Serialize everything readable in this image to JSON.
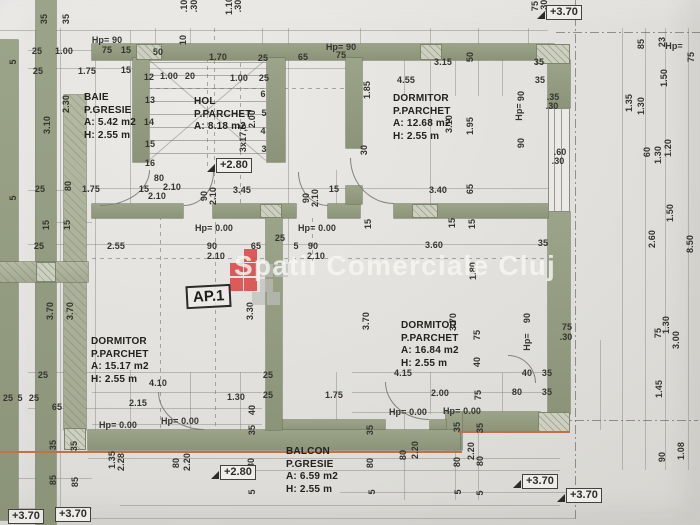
{
  "watermark": {
    "text": "Spatii Comerciale Cluj"
  },
  "ap_label": "AP.1",
  "colors": {
    "wall_green": "#8f987e",
    "paper": "#e0dfdb",
    "accent_orange": "#c0714a",
    "logo_red": "#d84343",
    "logo_gray": "#bdbdba",
    "text": "#35352f"
  },
  "rooms": {
    "baie": {
      "line1": "BAIE",
      "line2": "P.GRESIE",
      "area": "A: 5.42 m2",
      "height": "H: 2.55 m"
    },
    "hol": {
      "line1": "HOL",
      "line2": "P.PARCHET",
      "area": "A: 8.18 m2",
      "height": ""
    },
    "dormitor1": {
      "line1": "DORMITOR",
      "line2": "P.PARCHET",
      "area": "A: 12.68 m2",
      "height": "H: 2.55 m"
    },
    "dormitor2": {
      "line1": "DORMITOR",
      "line2": "P.PARCHET",
      "area": "A: 15.17 m2",
      "height": "H: 2.55 m"
    },
    "dormitor3": {
      "line1": "DORMITOR",
      "line2": "P.PARCHET",
      "area": "A: 16.84 m2",
      "height": "H: 2.55 m"
    },
    "balcon": {
      "line1": "BALCON",
      "line2": "P.GRESIE",
      "area": "A: 6.59 m2",
      "height": "H: 2.55 m"
    }
  },
  "level_markers": [
    {
      "text": "+3.70",
      "x": 546,
      "y": 2,
      "tri": 1
    },
    {
      "text": "+2.80",
      "x": 216,
      "y": 155,
      "tri": 1
    },
    {
      "text": "+2.80",
      "x": 220,
      "y": 462,
      "tri": 1
    },
    {
      "text": "+3.70",
      "x": 8,
      "y": 506
    },
    {
      "text": "+3.70",
      "x": 55,
      "y": 504
    },
    {
      "text": "+3.70",
      "x": 522,
      "y": 471,
      "tri": 1
    },
    {
      "text": "+3.70",
      "x": 566,
      "y": 485,
      "tri": 1
    }
  ],
  "dimensions": [
    {
      "t": "25",
      "x": 37,
      "y": 51
    },
    {
      "t": "1.00",
      "x": 64,
      "y": 51
    },
    {
      "t": "75",
      "x": 107,
      "y": 50
    },
    {
      "t": "15",
      "x": 126,
      "y": 50
    },
    {
      "t": "25",
      "x": 38,
      "y": 71
    },
    {
      "t": "1.75",
      "x": 87,
      "y": 71
    },
    {
      "t": "15",
      "x": 126,
      "y": 70
    },
    {
      "t": "50",
      "x": 158,
      "y": 52
    },
    {
      "t": "1.00",
      "x": 169,
      "y": 76
    },
    {
      "t": "20",
      "x": 190,
      "y": 76
    },
    {
      "t": "1.70",
      "x": 218,
      "y": 57
    },
    {
      "t": "25",
      "x": 263,
      "y": 58
    },
    {
      "t": "1.00",
      "x": 239,
      "y": 78
    },
    {
      "t": "25",
      "x": 264,
      "y": 78
    },
    {
      "t": "65",
      "x": 303,
      "y": 57
    },
    {
      "t": "75",
      "x": 341,
      "y": 55
    },
    {
      "t": "3.15",
      "x": 443,
      "y": 62
    },
    {
      "t": "50",
      "x": 470,
      "y": 57,
      "r": 1
    },
    {
      "t": "4.55",
      "x": 406,
      "y": 80
    },
    {
      "t": "35",
      "x": 539,
      "y": 62
    },
    {
      "t": "35",
      "x": 540,
      "y": 80
    },
    {
      "t": "Hp= 90",
      "x": 107,
      "y": 40
    },
    {
      "t": "Hp= 90",
      "x": 341,
      "y": 47
    },
    {
      "t": "Hp=",
      "x": 674,
      "y": 46
    },
    {
      "t": "75",
      "x": 691,
      "y": 57,
      "r": 1
    },
    {
      "t": ".10",
      "x": 184,
      "y": 6,
      "r": 1
    },
    {
      "t": ".30",
      "x": 194,
      "y": 6,
      "r": 1
    },
    {
      "t": "1.10",
      "x": 229,
      "y": 6,
      "r": 1
    },
    {
      "t": ".30",
      "x": 238,
      "y": 6,
      "r": 1
    },
    {
      "t": "75",
      "x": 535,
      "y": 6,
      "r": 1
    },
    {
      "t": ".30",
      "x": 544,
      "y": 6,
      "r": 1
    },
    {
      "t": "85",
      "x": 641,
      "y": 44,
      "r": 1
    },
    {
      "t": "23",
      "x": 662,
      "y": 42,
      "r": 1
    },
    {
      "t": "1.50",
      "x": 664,
      "y": 78,
      "r": 1
    },
    {
      "t": "1.35",
      "x": 629,
      "y": 103,
      "r": 1
    },
    {
      "t": "1.30",
      "x": 641,
      "y": 106,
      "r": 1
    },
    {
      "t": "60",
      "x": 647,
      "y": 152,
      "r": 1
    },
    {
      "t": "1.30",
      "x": 658,
      "y": 155,
      "r": 1
    },
    {
      "t": "1.20",
      "x": 668,
      "y": 148,
      "r": 1
    },
    {
      "t": "1.50",
      "x": 670,
      "y": 213,
      "r": 1
    },
    {
      "t": "2.60",
      "x": 652,
      "y": 239,
      "r": 1
    },
    {
      "t": "8.50",
      "x": 690,
      "y": 244,
      "r": 1
    },
    {
      "t": "75",
      "x": 658,
      "y": 333,
      "r": 1
    },
    {
      "t": "1.30",
      "x": 666,
      "y": 325,
      "r": 1
    },
    {
      "t": "3.00",
      "x": 676,
      "y": 340,
      "r": 1
    },
    {
      "t": "1.45",
      "x": 659,
      "y": 389,
      "r": 1
    },
    {
      "t": "90",
      "x": 662,
      "y": 457,
      "r": 1
    },
    {
      "t": "1.08",
      "x": 681,
      "y": 451,
      "r": 1
    },
    {
      "t": ".35",
      "x": 553,
      "y": 97
    },
    {
      "t": ".30",
      "x": 552,
      "y": 106
    },
    {
      "t": ".60",
      "x": 560,
      "y": 152
    },
    {
      "t": ".30",
      "x": 558,
      "y": 161
    },
    {
      "t": "75",
      "x": 567,
      "y": 327
    },
    {
      "t": ".30",
      "x": 566,
      "y": 337
    },
    {
      "t": "90",
      "x": 521,
      "y": 96,
      "r": 1
    },
    {
      "t": "Hp=",
      "x": 519,
      "y": 112,
      "r": 1
    },
    {
      "t": "90",
      "x": 521,
      "y": 143,
      "r": 1
    },
    {
      "t": "90",
      "x": 527,
      "y": 318,
      "r": 1
    },
    {
      "t": "Hp=",
      "x": 527,
      "y": 342,
      "r": 1
    },
    {
      "t": "1.85",
      "x": 367,
      "y": 90,
      "r": 1
    },
    {
      "t": "3.10",
      "x": 449,
      "y": 124,
      "r": 1
    },
    {
      "t": "1.95",
      "x": 470,
      "y": 126,
      "r": 1
    },
    {
      "t": "30",
      "x": 364,
      "y": 150,
      "r": 1
    },
    {
      "t": "3.10",
      "x": 47,
      "y": 125,
      "r": 1
    },
    {
      "t": "2.30",
      "x": 66,
      "y": 104,
      "r": 1
    },
    {
      "t": "35",
      "x": 44,
      "y": 19,
      "r": 1
    },
    {
      "t": "35",
      "x": 66,
      "y": 19,
      "r": 1
    },
    {
      "t": "5",
      "x": 13,
      "y": 62,
      "r": 1
    },
    {
      "t": "5",
      "x": 13,
      "y": 198,
      "r": 1
    },
    {
      "t": "12",
      "x": 149,
      "y": 77
    },
    {
      "t": "13",
      "x": 150,
      "y": 100
    },
    {
      "t": "14",
      "x": 149,
      "y": 122
    },
    {
      "t": "15",
      "x": 150,
      "y": 144
    },
    {
      "t": "16",
      "x": 150,
      "y": 163
    },
    {
      "t": "10",
      "x": 183,
      "y": 40,
      "r": 1
    },
    {
      "t": "6",
      "x": 263,
      "y": 94
    },
    {
      "t": "5",
      "x": 264,
      "y": 113
    },
    {
      "t": "4",
      "x": 263,
      "y": 131
    },
    {
      "t": "3",
      "x": 264,
      "y": 149
    },
    {
      "t": "2.00",
      "x": 252,
      "y": 119,
      "r": 1
    },
    {
      "t": "3x17,5",
      "x": 243,
      "y": 138,
      "r": 1
    },
    {
      "t": "80",
      "x": 159,
      "y": 178
    },
    {
      "t": "2.10",
      "x": 172,
      "y": 187
    },
    {
      "t": "25",
      "x": 40,
      "y": 189
    },
    {
      "t": "80",
      "x": 68,
      "y": 186,
      "r": 1
    },
    {
      "t": "1.75",
      "x": 91,
      "y": 189
    },
    {
      "t": "15",
      "x": 144,
      "y": 189
    },
    {
      "t": "2.10",
      "x": 157,
      "y": 196
    },
    {
      "t": "90",
      "x": 204,
      "y": 196,
      "r": 1
    },
    {
      "t": "2.10",
      "x": 213,
      "y": 196,
      "r": 1
    },
    {
      "t": "3.45",
      "x": 242,
      "y": 190
    },
    {
      "t": "90",
      "x": 306,
      "y": 198,
      "r": 1
    },
    {
      "t": "2.10",
      "x": 315,
      "y": 198,
      "r": 1
    },
    {
      "t": "15",
      "x": 334,
      "y": 189
    },
    {
      "t": "3.40",
      "x": 438,
      "y": 190
    },
    {
      "t": "65",
      "x": 470,
      "y": 189,
      "r": 1
    },
    {
      "t": "15",
      "x": 368,
      "y": 224,
      "r": 1
    },
    {
      "t": "15",
      "x": 452,
      "y": 223,
      "r": 1
    },
    {
      "t": "15",
      "x": 472,
      "y": 224,
      "r": 1
    },
    {
      "t": "3.60",
      "x": 434,
      "y": 245
    },
    {
      "t": "35",
      "x": 543,
      "y": 243
    },
    {
      "t": "1.80",
      "x": 473,
      "y": 271,
      "r": 1
    },
    {
      "t": "15",
      "x": 46,
      "y": 225,
      "r": 1
    },
    {
      "t": "15",
      "x": 67,
      "y": 225,
      "r": 1
    },
    {
      "t": "25",
      "x": 39,
      "y": 246
    },
    {
      "t": "2.55",
      "x": 116,
      "y": 246
    },
    {
      "t": "Hp= 0.00",
      "x": 214,
      "y": 228
    },
    {
      "t": "Hp= 0.00",
      "x": 317,
      "y": 228
    },
    {
      "t": "90",
      "x": 212,
      "y": 246
    },
    {
      "t": "2.10",
      "x": 216,
      "y": 256
    },
    {
      "t": "65",
      "x": 256,
      "y": 246
    },
    {
      "t": "25",
      "x": 280,
      "y": 238
    },
    {
      "t": "5",
      "x": 296,
      "y": 246
    },
    {
      "t": "90",
      "x": 313,
      "y": 246
    },
    {
      "t": "2.10",
      "x": 316,
      "y": 256
    },
    {
      "t": "3.70",
      "x": 50,
      "y": 311,
      "r": 1
    },
    {
      "t": "3.70",
      "x": 70,
      "y": 311,
      "r": 1
    },
    {
      "t": "3.30",
      "x": 250,
      "y": 311,
      "r": 1
    },
    {
      "t": "3.70",
      "x": 366,
      "y": 321,
      "r": 1
    },
    {
      "t": "3.70",
      "x": 453,
      "y": 322,
      "r": 1
    },
    {
      "t": "75",
      "x": 477,
      "y": 335,
      "r": 1
    },
    {
      "t": "25",
      "x": 43,
      "y": 375
    },
    {
      "t": "25",
      "x": 268,
      "y": 375
    },
    {
      "t": "4.10",
      "x": 158,
      "y": 383
    },
    {
      "t": "2.15",
      "x": 138,
      "y": 403
    },
    {
      "t": "1.30",
      "x": 236,
      "y": 397
    },
    {
      "t": "25",
      "x": 268,
      "y": 395
    },
    {
      "t": "65",
      "x": 57,
      "y": 407
    },
    {
      "t": "25",
      "x": 8,
      "y": 398
    },
    {
      "t": "5",
      "x": 20,
      "y": 398
    },
    {
      "t": "25",
      "x": 34,
      "y": 398
    },
    {
      "t": "1.75",
      "x": 334,
      "y": 395
    },
    {
      "t": "Hp= 0.00",
      "x": 118,
      "y": 425
    },
    {
      "t": "Hp= 0.00",
      "x": 180,
      "y": 421
    },
    {
      "t": "40",
      "x": 252,
      "y": 410,
      "r": 1
    },
    {
      "t": "35",
      "x": 252,
      "y": 430,
      "r": 1
    },
    {
      "t": "35",
      "x": 53,
      "y": 445,
      "r": 1
    },
    {
      "t": "35",
      "x": 74,
      "y": 446,
      "r": 1
    },
    {
      "t": "1.35",
      "x": 112,
      "y": 460,
      "r": 1
    },
    {
      "t": "2.28",
      "x": 121,
      "y": 462,
      "r": 1
    },
    {
      "t": "80",
      "x": 176,
      "y": 463,
      "r": 1
    },
    {
      "t": "2.20",
      "x": 187,
      "y": 462,
      "r": 1
    },
    {
      "t": "85",
      "x": 53,
      "y": 480,
      "r": 1
    },
    {
      "t": "85",
      "x": 75,
      "y": 482,
      "r": 1
    },
    {
      "t": "80",
      "x": 251,
      "y": 463,
      "r": 1
    },
    {
      "t": "35",
      "x": 370,
      "y": 430,
      "r": 1
    },
    {
      "t": "80",
      "x": 370,
      "y": 463,
      "r": 1
    },
    {
      "t": "5",
      "x": 252,
      "y": 492,
      "r": 1
    },
    {
      "t": "4.15",
      "x": 403,
      "y": 373
    },
    {
      "t": "2.00",
      "x": 440,
      "y": 393
    },
    {
      "t": "40",
      "x": 477,
      "y": 362,
      "r": 1
    },
    {
      "t": "75",
      "x": 478,
      "y": 395,
      "r": 1
    },
    {
      "t": "40",
      "x": 527,
      "y": 373
    },
    {
      "t": "80",
      "x": 517,
      "y": 392
    },
    {
      "t": "35",
      "x": 547,
      "y": 373
    },
    {
      "t": "35",
      "x": 547,
      "y": 392
    },
    {
      "t": "Hp= 0.00",
      "x": 408,
      "y": 412
    },
    {
      "t": "Hp= 0.00",
      "x": 462,
      "y": 411
    },
    {
      "t": "35",
      "x": 457,
      "y": 427,
      "r": 1
    },
    {
      "t": "35",
      "x": 480,
      "y": 428,
      "r": 1
    },
    {
      "t": "2.20",
      "x": 415,
      "y": 450,
      "r": 1
    },
    {
      "t": "2.20",
      "x": 471,
      "y": 451,
      "r": 1
    },
    {
      "t": "80",
      "x": 403,
      "y": 455,
      "r": 1
    },
    {
      "t": "80",
      "x": 457,
      "y": 462,
      "r": 1
    },
    {
      "t": "80",
      "x": 480,
      "y": 461,
      "r": 1
    },
    {
      "t": "5",
      "x": 372,
      "y": 492,
      "r": 1
    },
    {
      "t": "5",
      "x": 458,
      "y": 492,
      "r": 1
    },
    {
      "t": "5",
      "x": 480,
      "y": 493,
      "r": 1
    }
  ]
}
